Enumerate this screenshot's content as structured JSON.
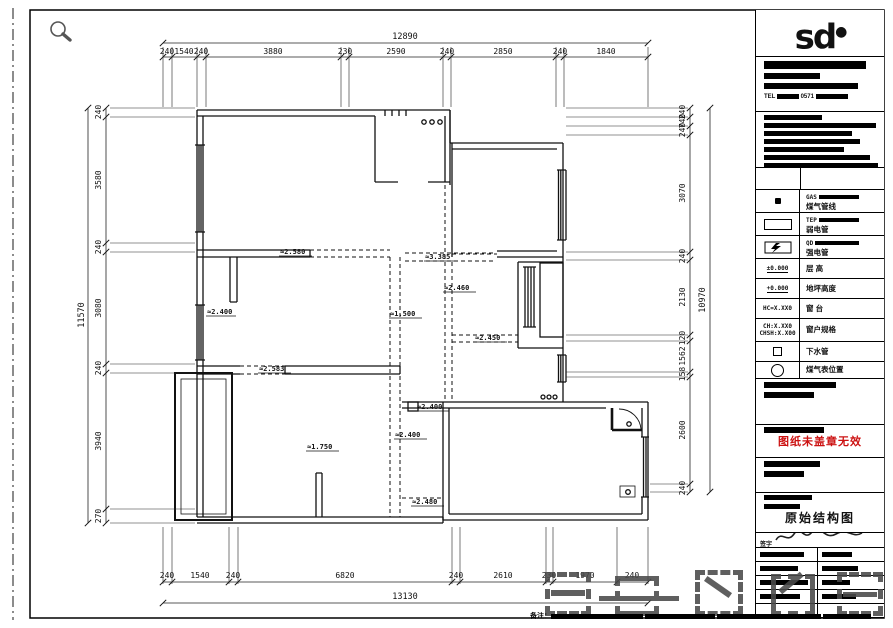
{
  "dims": {
    "top": {
      "overall": "12890",
      "segments": [
        "240",
        "1540",
        "240",
        "3880",
        "230",
        "2590",
        "240",
        "2850",
        "240",
        "1840"
      ]
    },
    "bottom": {
      "overall": "13130",
      "segments": [
        "240",
        "1540",
        "240",
        "6820",
        "240",
        "2610",
        "230",
        "1970",
        "240"
      ]
    },
    "left": {
      "overall": "11570",
      "segments": [
        "240",
        "3580",
        "240",
        "3080",
        "240",
        "3940",
        "270"
      ]
    },
    "right": {
      "overall": "10970",
      "segments": [
        "240",
        "740",
        "240",
        "3070",
        "240",
        "2130",
        "120",
        "1562",
        "158",
        "2600",
        "240"
      ]
    }
  },
  "plan": {
    "labels": [
      "≈2.580",
      "≈3.385",
      "≈2.460",
      "≈1.500",
      "≈2.400",
      "≈2.583",
      "≈2.450",
      "≈2.400",
      "≈2.400",
      "≈1.750",
      "≈2.480"
    ]
  },
  "titleblock": {
    "logo_text": "sd",
    "tel_label": "TEL",
    "tel_code": "0571",
    "legend": [
      {
        "code": "GAS",
        "label": "煤气管线"
      },
      {
        "code": "TEP",
        "label": "弱电管"
      },
      {
        "code": "QD",
        "label": "强电管"
      },
      {
        "code": "±0.000",
        "label": "层 高"
      },
      {
        "code": "+0.000",
        "label": "地坪高度"
      },
      {
        "code": "HC=X.XX0",
        "label": "窗 台"
      },
      {
        "code": "CH:X.XX0",
        "code2": "CHSH:X.X00",
        "label": "窗户规格"
      },
      {
        "code": "",
        "label": "下水管"
      },
      {
        "code": "",
        "label": "煤气表位置"
      }
    ],
    "stamp_text": "图纸未盖章无效",
    "drawing_title": "原始结构图",
    "sign_label": "签字"
  },
  "footer": {
    "note_prefix": "备注："
  },
  "colors": {
    "line": "#111111",
    "stamp": "#cc1111",
    "watermark": "#4a4a4a"
  }
}
